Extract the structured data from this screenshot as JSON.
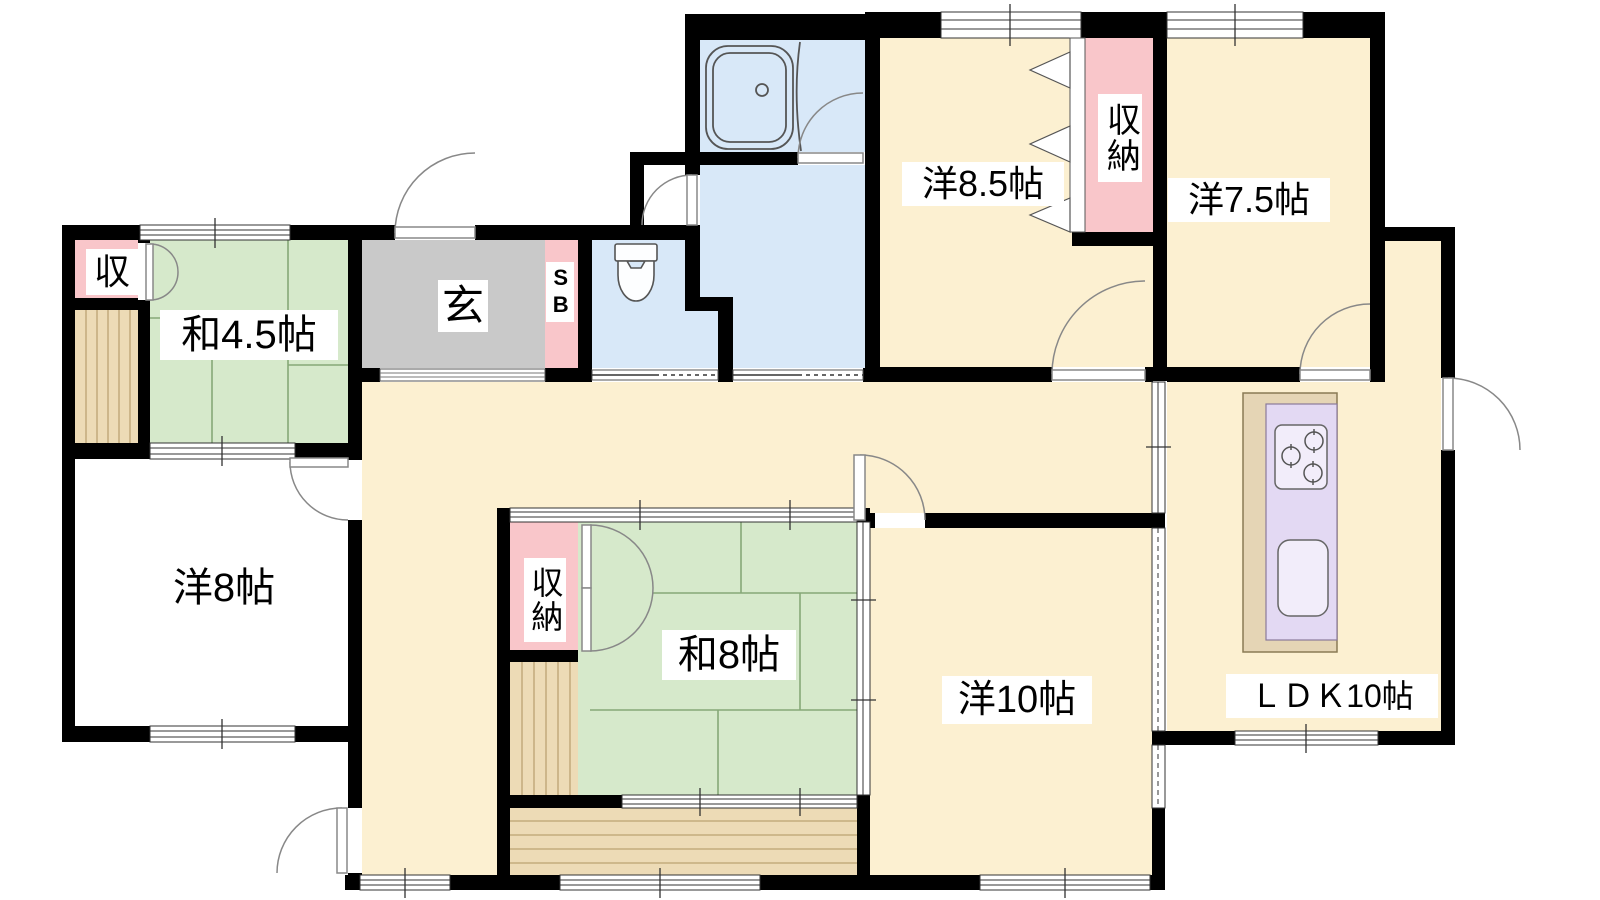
{
  "page": {
    "title": "間取り図"
  },
  "colors": {
    "wall": "#000000",
    "tatami": "#d6e9cb",
    "western": "#fcf0d1",
    "wet": "#d8e8f8",
    "closet": "#f9c6ca",
    "entrance": "#c9c9c9",
    "wood": "#eddbb6",
    "woodline": "#bca272",
    "counter": "#e3d9f3",
    "cabinet": "#e5d5b5",
    "fixture": "#f2edfa",
    "tatamiline": "#86a878",
    "doorline": "#888888"
  },
  "rooms": {
    "wa45": {
      "label": "和4.5帖"
    },
    "closet_left": {
      "label": "収"
    },
    "genkan": {
      "label": "玄"
    },
    "shoebox": {
      "label": "SB"
    },
    "yo85": {
      "label": "洋8.5帖"
    },
    "closet85": {
      "label": "収納"
    },
    "yo75": {
      "label": "洋7.5帖"
    },
    "yo8": {
      "label": "洋8帖"
    },
    "wa8": {
      "label": "和8帖"
    },
    "closet_wa8": {
      "label": "収納"
    },
    "yo10": {
      "label": "洋10帖"
    },
    "ldk": {
      "label": "ＬＤＫ10帖"
    }
  },
  "fixtures": {
    "bathtub": "bathtub",
    "toilet": "toilet",
    "stove": "kitchen-stove",
    "sink": "kitchen-sink"
  }
}
